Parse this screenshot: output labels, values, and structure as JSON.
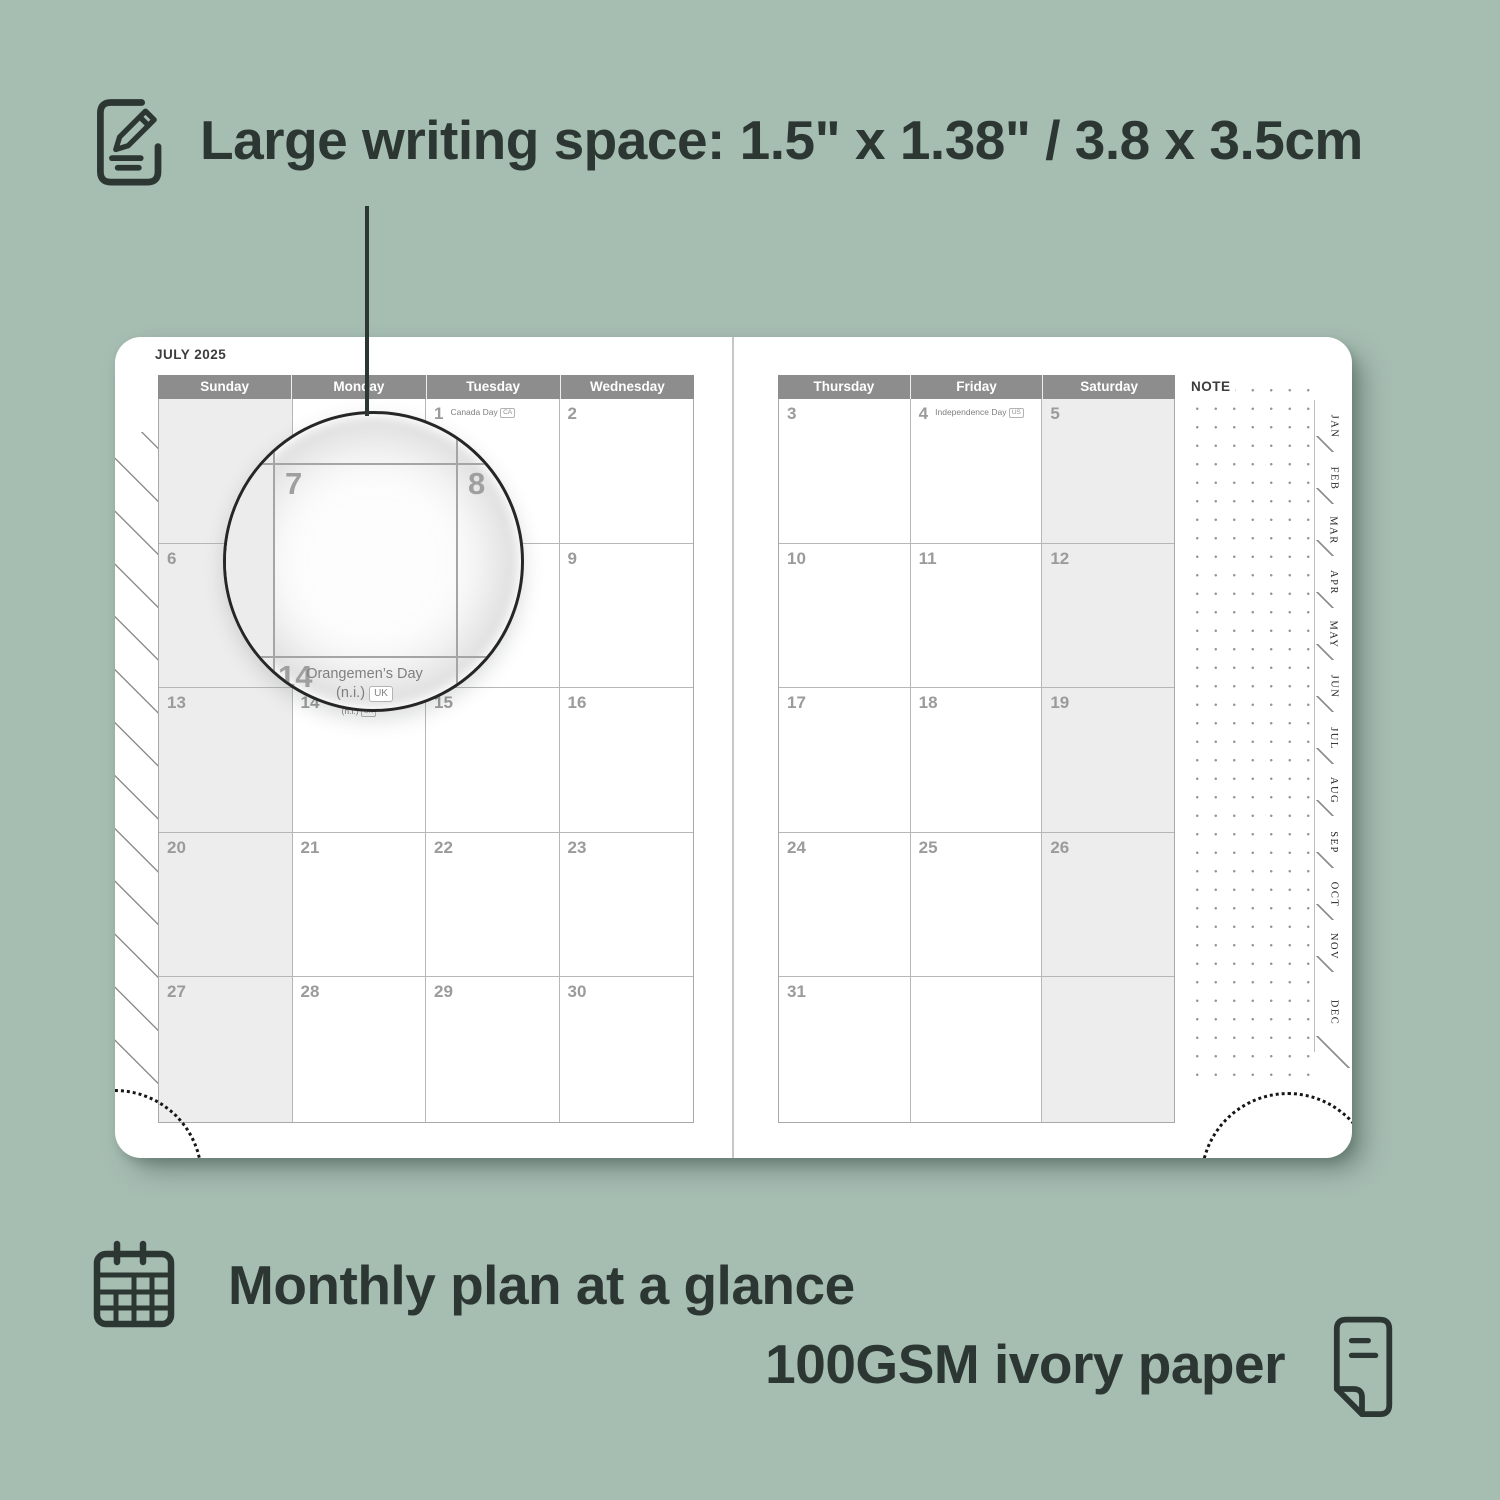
{
  "top_feature": {
    "icon": "pencil-note-icon",
    "label": "Large writing space: 1.5\" x 1.38\" / 3.8 x 3.5cm"
  },
  "planner": {
    "month_title": "JULY 2025",
    "left_day_headers": [
      "Sunday",
      "Monday",
      "Tuesday",
      "Wednesday"
    ],
    "right_day_headers": [
      "Thursday",
      "Friday",
      "Saturday"
    ],
    "note_label": "NOTE",
    "month_tabs": [
      "JAN",
      "FEB",
      "MAR",
      "APR",
      "MAY",
      "JUN",
      "JUL",
      "AUG",
      "SEP",
      "OCT",
      "NOV",
      "DEC"
    ],
    "left_weeks": [
      [
        {
          "date": ""
        },
        {
          "date": ""
        },
        {
          "date": "1",
          "holiday": "Canada Day",
          "badge": "CA",
          "style": "inline"
        },
        {
          "date": "2"
        }
      ],
      [
        {
          "date": "6"
        },
        {
          "date": "7"
        },
        {
          "date": "8"
        },
        {
          "date": "9"
        }
      ],
      [
        {
          "date": "13"
        },
        {
          "date": "14",
          "holiday_lines": [
            "Orangemen’s Day",
            "(n.i.)"
          ],
          "badge": "UK",
          "style": "stacked"
        },
        {
          "date": "15"
        },
        {
          "date": "16"
        }
      ],
      [
        {
          "date": "20"
        },
        {
          "date": "21"
        },
        {
          "date": "22"
        },
        {
          "date": "23"
        }
      ],
      [
        {
          "date": "27"
        },
        {
          "date": "28"
        },
        {
          "date": "29"
        },
        {
          "date": "30"
        }
      ]
    ],
    "right_weeks": [
      [
        {
          "date": "3"
        },
        {
          "date": "4",
          "holiday": "Independence Day",
          "badge": "US",
          "style": "inline"
        },
        {
          "date": "5"
        }
      ],
      [
        {
          "date": "10"
        },
        {
          "date": "11"
        },
        {
          "date": "12"
        }
      ],
      [
        {
          "date": "17"
        },
        {
          "date": "18"
        },
        {
          "date": "19"
        }
      ],
      [
        {
          "date": "24"
        },
        {
          "date": "25"
        },
        {
          "date": "26"
        }
      ],
      [
        {
          "date": "31"
        },
        {
          "date": ""
        },
        {
          "date": ""
        }
      ]
    ]
  },
  "magnifier": {
    "day_main": "7",
    "day_next": "8",
    "day_below": "14",
    "holiday_line1": "Orangemen’s Day",
    "holiday_line2": "(n.i.)",
    "badge": "UK"
  },
  "bottom_features": {
    "monthly": {
      "icon": "calendar-grid-icon",
      "label": "Monthly plan at a glance"
    },
    "paper": {
      "icon": "paper-icon",
      "label": "100GSM ivory paper"
    }
  },
  "colors": {
    "background": "#a6bdb2",
    "ink": "#2c3733",
    "header_bar": "#8d8d8d",
    "weekend_fill": "#ededed",
    "date_number": "#9b9b9b"
  }
}
